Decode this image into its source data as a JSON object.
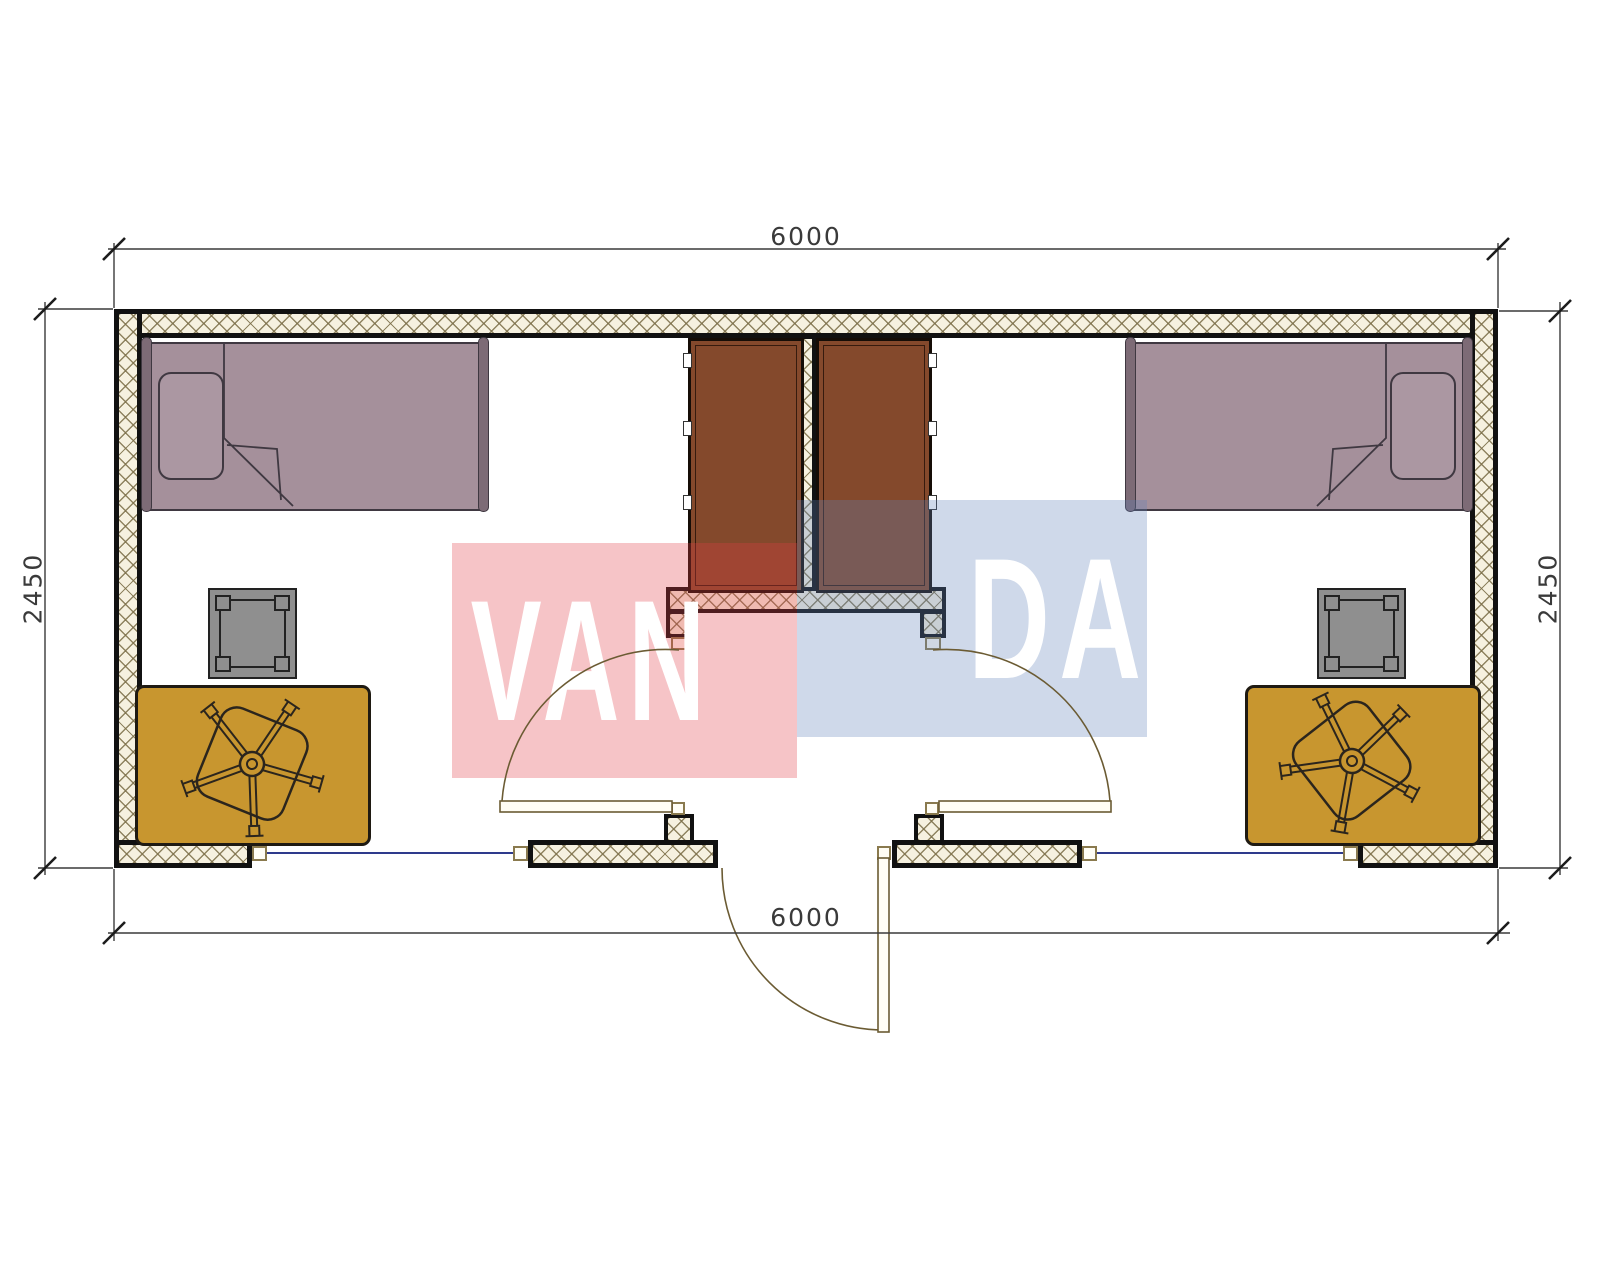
{
  "title": "Two-room cabin floor plan 6000 x 2450",
  "dimensions": {
    "top_width": "6000",
    "bottom_width": "6000",
    "left_height": "2450",
    "right_height": "2450"
  },
  "watermark": {
    "word": "VANDA",
    "left_text": "VAN",
    "right_text": "DA",
    "red_block_color": "#E13C46",
    "blue_block_color": "#5F82B9"
  },
  "colors": {
    "wall_fill": "#F6F1E0",
    "wall_line": "#111111",
    "bed": "#A5909B",
    "wardrobe": "#84492C",
    "desk": "#C8962F",
    "stool": "#8F8F8F",
    "window_glass": "#2E3A8C",
    "dimension_text": "#3A3A3A"
  },
  "legend": {
    "furniture": [
      "single-bed",
      "wardrobe",
      "desk",
      "office-chair",
      "stool"
    ],
    "openings": [
      "entry-door",
      "room-door-left",
      "room-door-right",
      "window-left",
      "window-right"
    ]
  }
}
